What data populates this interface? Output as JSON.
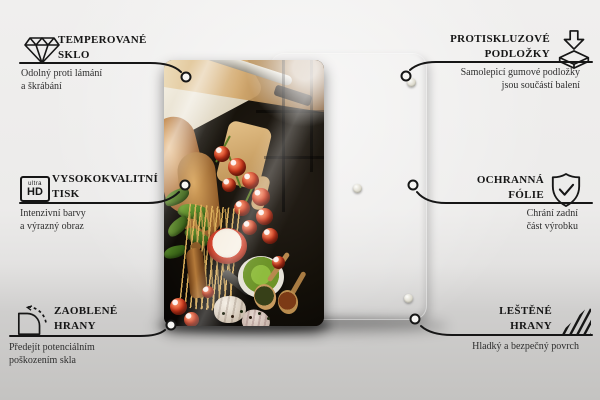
{
  "colors": {
    "accent_ink": "#161616",
    "background_top": "#f0efee",
    "background_bottom": "#c4c3c1",
    "back_panel_beige": "#dcd9ca",
    "glass_black": "#0b0807",
    "tomato_red": "#d43a1d",
    "basil_green": "#3f6d22",
    "pesto_green": "#7ca832"
  },
  "product": {
    "front_panel": "glass-board-with-italian-food-photo",
    "back_panel": "beige-rear-panel",
    "rubber_pads_visible": 3
  },
  "features": {
    "top_left": {
      "icon": "diamond-icon",
      "title_line1": "TEMPEROVANÉ",
      "title_line2": "SKLO",
      "desc_line1": "Odolný proti lámání",
      "desc_line2": "a škrábání"
    },
    "top_right": {
      "icon": "anti-slip-pad-icon",
      "title_line1": "PROTISKLUZOVÉ",
      "title_line2": "PODLOŽKY",
      "desc_line1": "Samolepicí gumové podložky",
      "desc_line2": "jsou součástí balení"
    },
    "middle_left": {
      "icon": "ultra-hd-icon",
      "icon_label_top": "ultra",
      "icon_label_bottom": "HD",
      "title_line1": "VYSOKOKVALITNÍ",
      "title_line2": "TISK",
      "desc_line1": "Intenzivní barvy",
      "desc_line2": "a výrazný obraz"
    },
    "middle_right": {
      "icon": "shield-check-icon",
      "title_line1": "OCHRANNÁ",
      "title_line2": "FÓLIE",
      "desc_line1": "Chrání zadní",
      "desc_line2": "část výrobku"
    },
    "bottom_left": {
      "icon": "rounded-corner-icon",
      "title_line1": "ZAOBLENÉ",
      "title_line2": "HRANY",
      "desc_line1": "Předejít potenciálním",
      "desc_line2": "poškozením skla"
    },
    "bottom_right": {
      "icon": "polished-edges-icon",
      "title_line1": "LEŠTĚNÉ",
      "title_line2": "HRANY",
      "desc_line1": "Hladký a bezpečný povrch",
      "desc_line2": ""
    }
  }
}
